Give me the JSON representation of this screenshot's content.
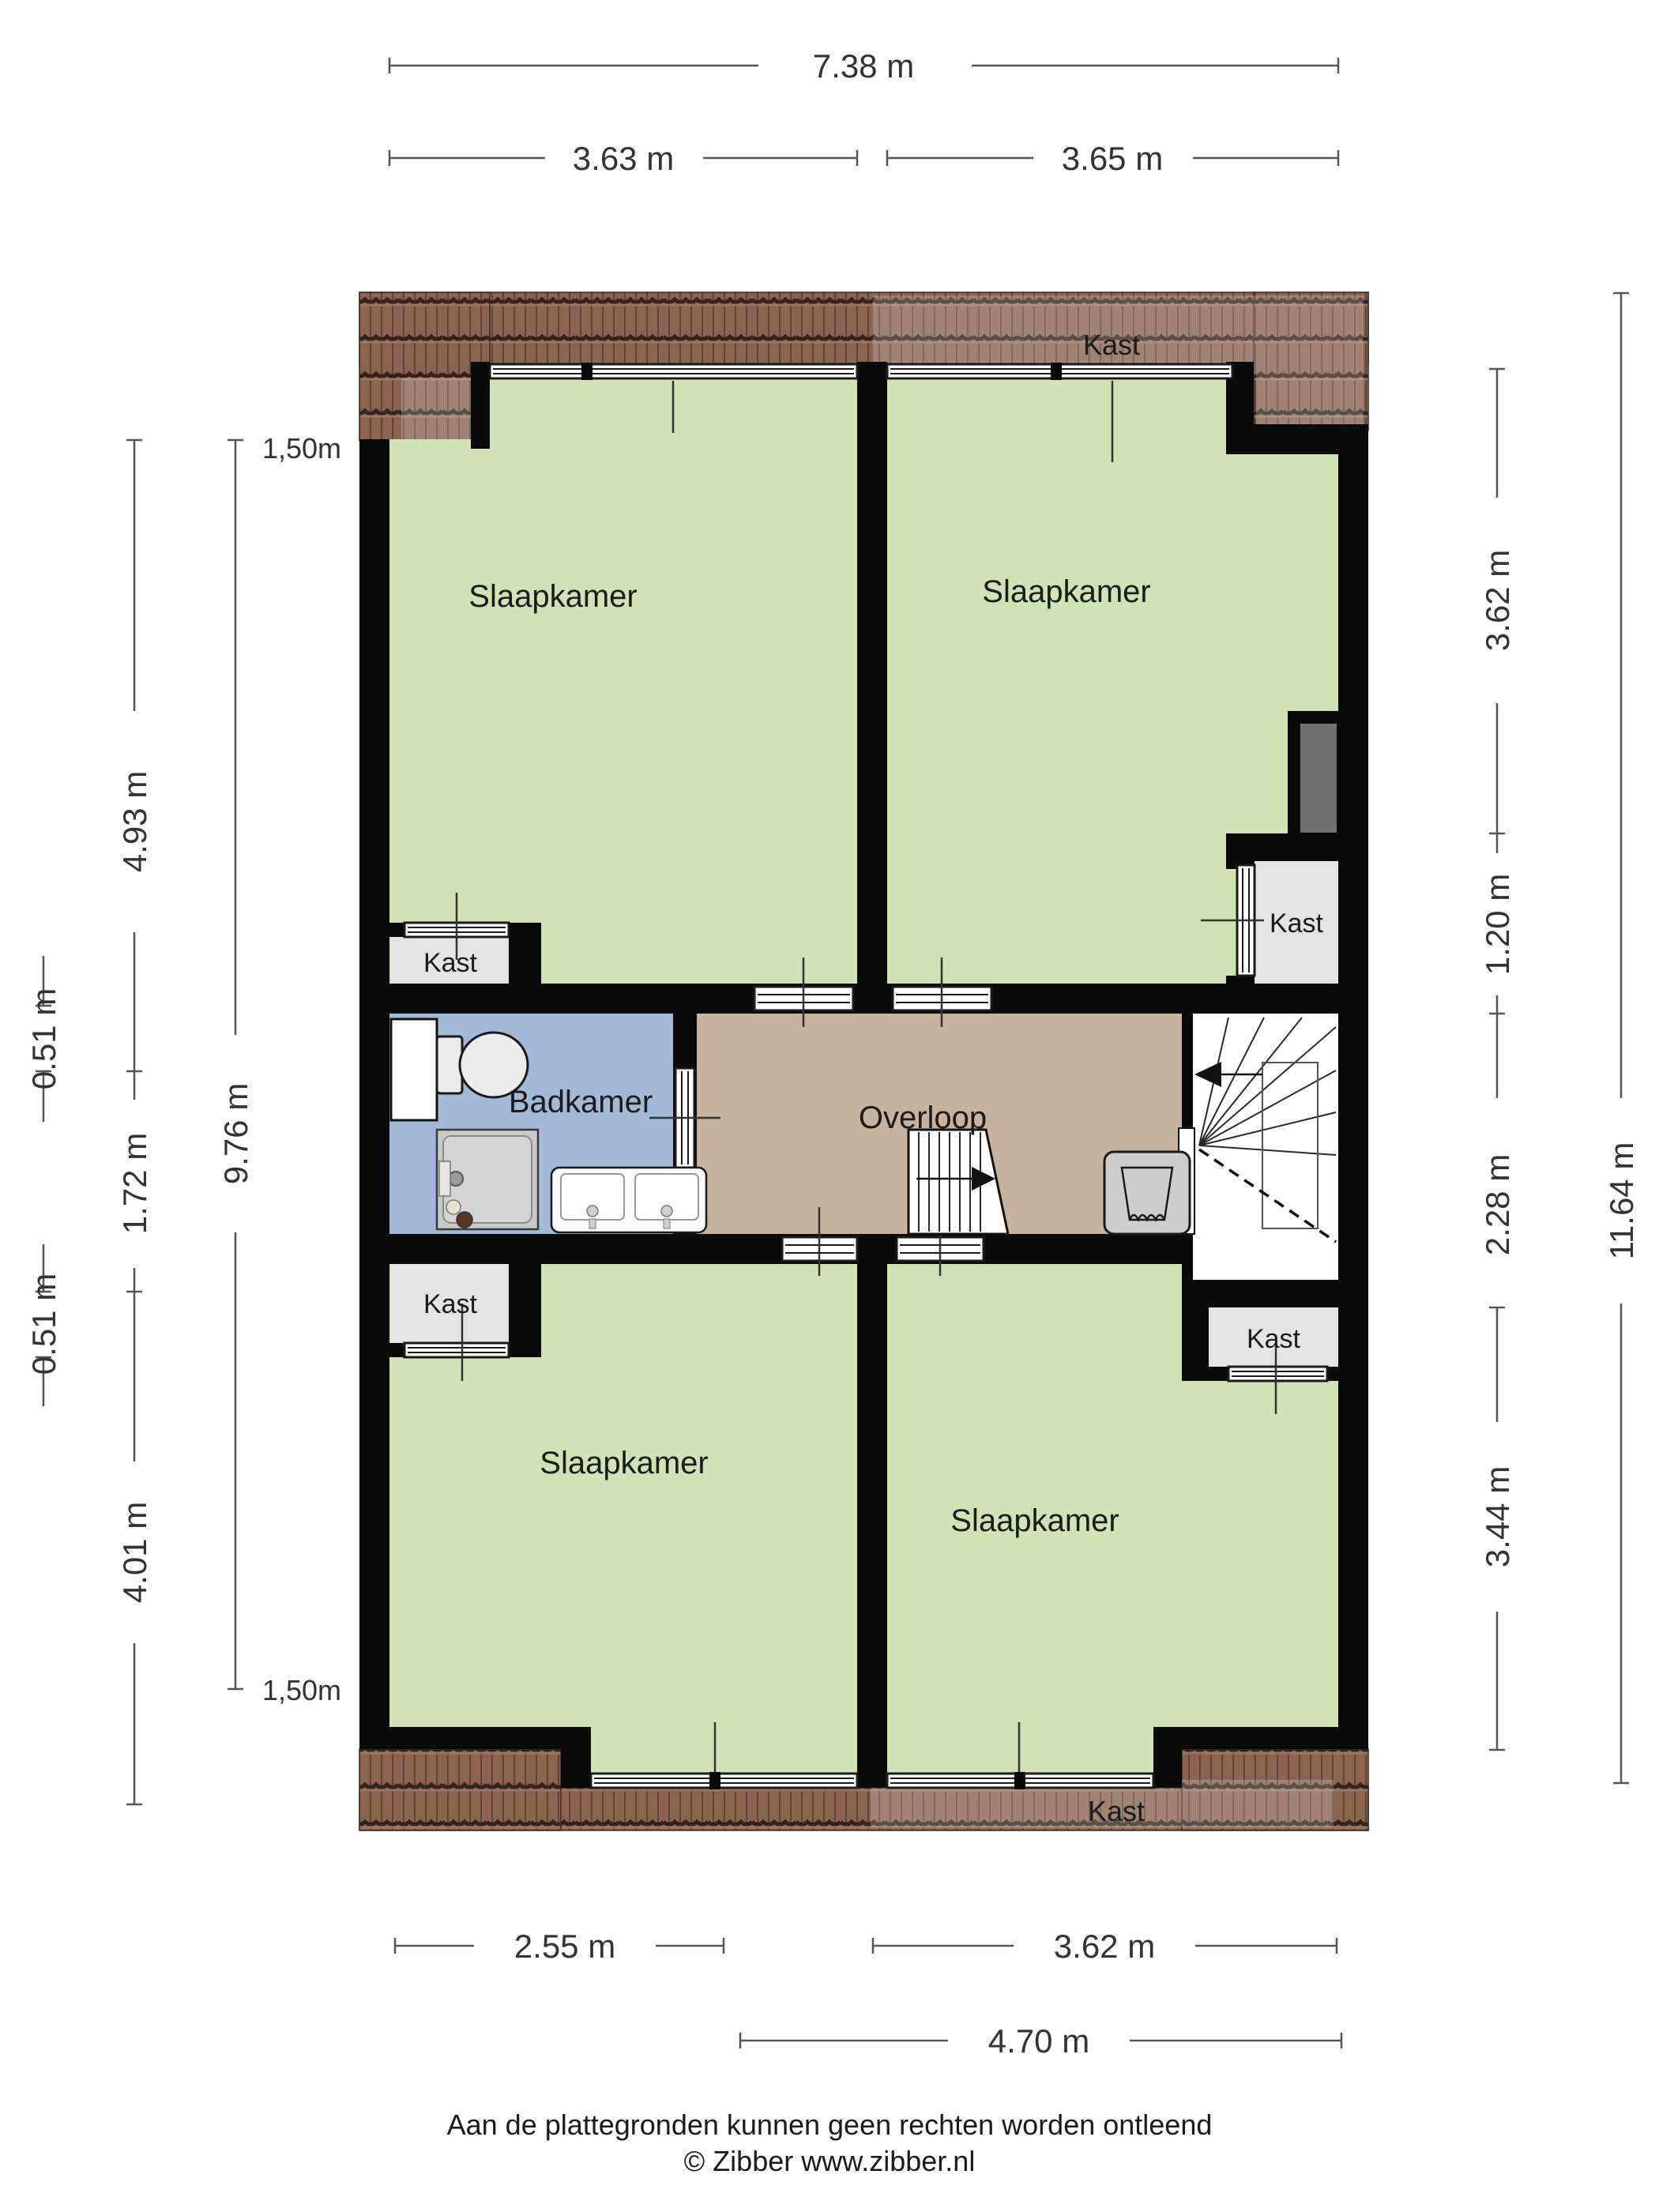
{
  "title": "Floor plan - verdieping (Zibber plattegrond)",
  "rooms": {
    "bedroom_top_left": "Slaapkamer",
    "bedroom_top_right": "Slaapkamer",
    "bedroom_bottom_left": "Slaapkamer",
    "bedroom_bottom_right": "Slaapkamer",
    "bathroom": "Badkamer",
    "landing": "Overloop",
    "closet_top_left": "Kast",
    "closet_right": "Kast",
    "closet_bottom_left": "Kast",
    "closet_bottom_right": "Kast",
    "closet_attic_top": "Kast",
    "closet_attic_bottom": "Kast"
  },
  "dimensions": {
    "top_total": "7.38 m",
    "top_left_room": "3.63 m",
    "top_right_room": "3.65 m",
    "left_roofline_top": "1,50m",
    "left_roofline_bottom": "1,50m",
    "left_upper_room": "4.93 m",
    "left_upper_closet": "0.51 m",
    "left_bathroom": "1.72 m",
    "left_lower_closet": "0.51 m",
    "left_lower_room": "4.01 m",
    "left_span": "9.76 m",
    "right_upper_room": "3.62 m",
    "right_closet": "1.20 m",
    "right_stairwell": "2.28 m",
    "right_lower_room": "3.44 m",
    "right_total": "11.64 m",
    "bottom_left_room": "2.55 m",
    "bottom_right_room": "3.62 m",
    "bottom_span": "4.70 m"
  },
  "footer": {
    "disclaimer": "Aan de plattegronden kunnen geen rechten worden ontleend",
    "copyright": "© Zibber www.zibber.nl"
  },
  "colors": {
    "room_green": "#cfe3b5",
    "bathroom_blue": "#a3b9d8",
    "landing_tan": "#c9b39f",
    "closet_grey": "#e4e4e4",
    "duct_grey": "#707070",
    "wall_black": "#0a0a0a",
    "roof_base": "#8a6351",
    "roof_tile_line": "#5e4437",
    "roof_row_dark": "#33231c",
    "roof_row_light": "#9d7660",
    "stair_white": "#ffffff",
    "fixture_grey": "#cdcdcd",
    "dim_line": "#555555",
    "dim_text": "#333333",
    "label_text": "#1b1b1b"
  }
}
